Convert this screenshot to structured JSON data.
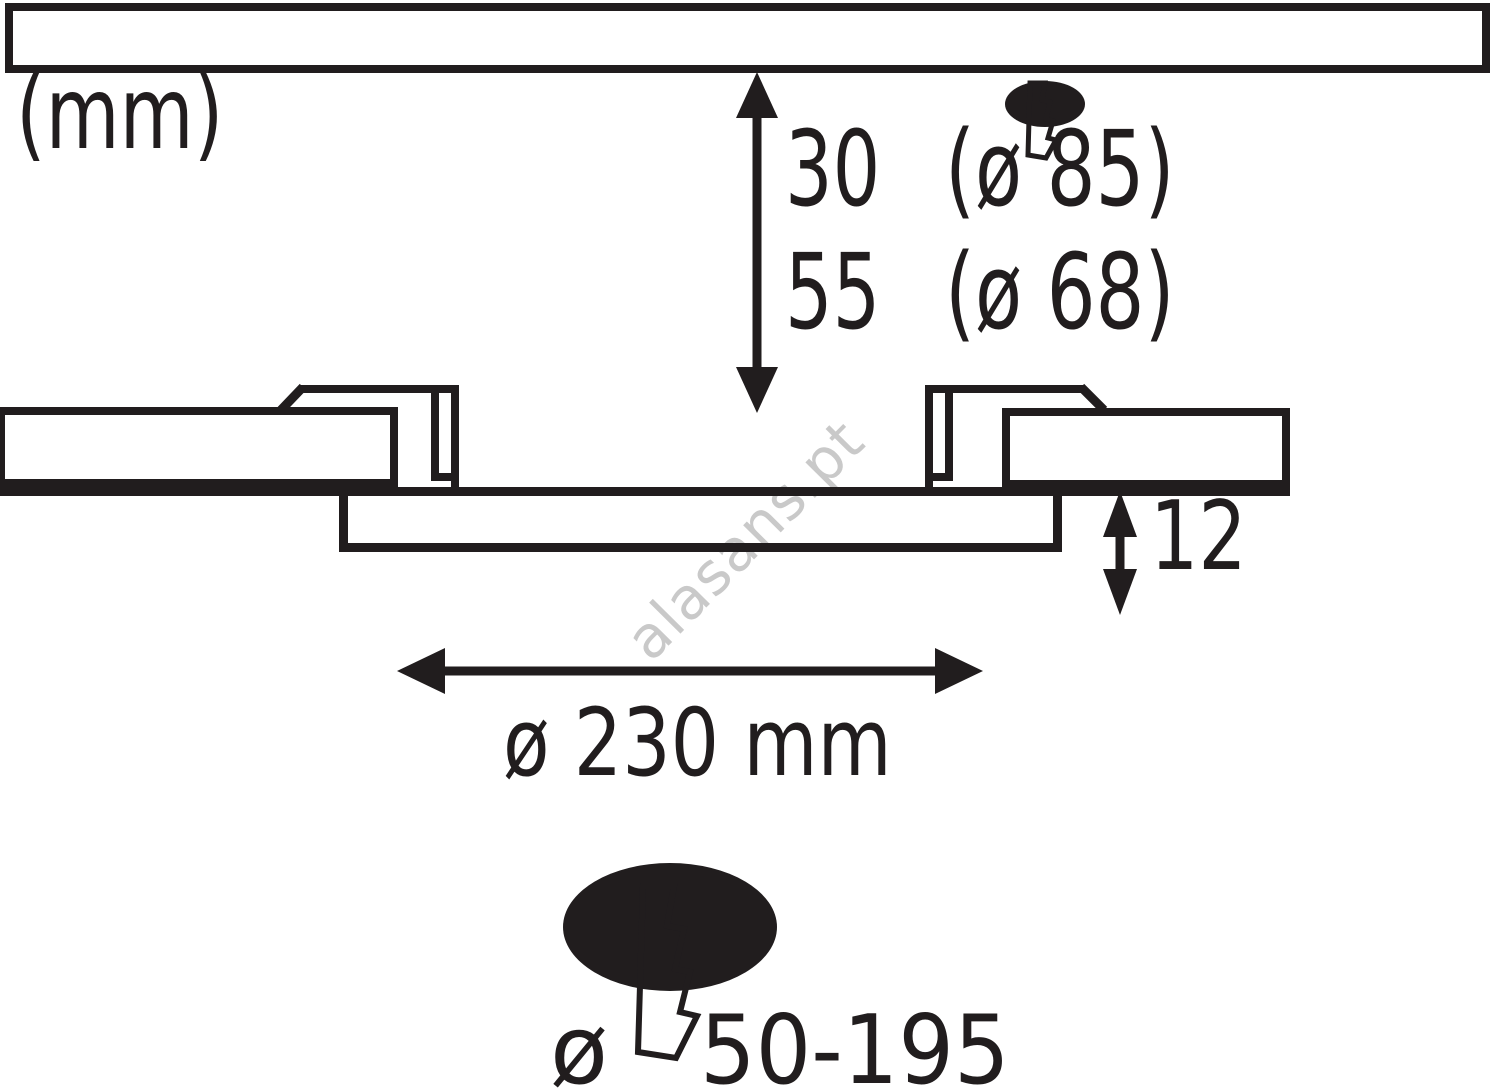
{
  "unit_label": "(mm)",
  "depth_dimension": {
    "value_30": "30",
    "detail_30": "(ø 85)",
    "value_55": "55",
    "detail_55": "(ø 68)"
  },
  "protrusion_dimension": "12",
  "cutout_dimension": "ø 230 mm",
  "installation_depth": {
    "diameter_symbol": "ø",
    "range": "50-195"
  },
  "watermark": "alasans.pt",
  "icons": {
    "top_transformer": "lightning-bolt-ellipse-icon",
    "bottom_transformer": "lightning-bolt-ellipse-icon"
  },
  "colors": {
    "line": "#211d1e",
    "ceiling_fill": "#b6bac0",
    "mounting_panel_fill": "#65686b",
    "bolt_fill": "#ffffff",
    "watermark": "#c9c9c9",
    "background": "#ffffff"
  }
}
